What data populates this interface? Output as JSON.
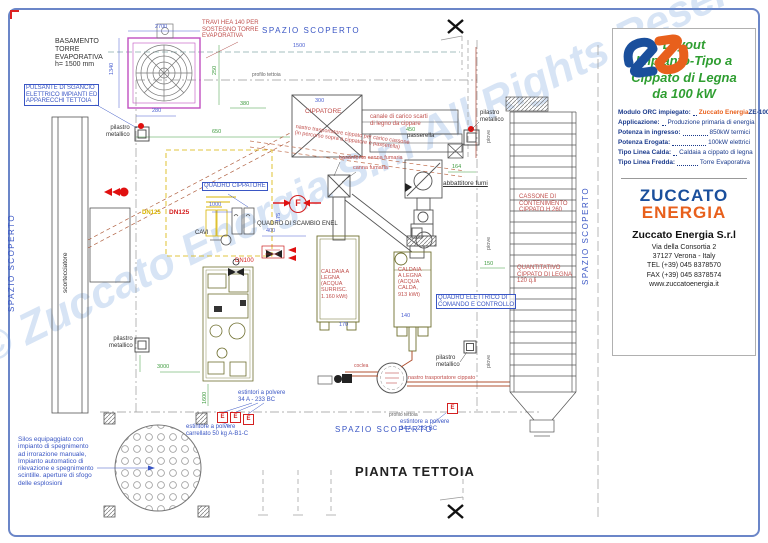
{
  "watermark": "© Zuccato Energia S.r.l All Rights Reserved",
  "panel": {
    "title": "Layout\nImpianto-Tipo a\nCippato di Legna\nda 100 kW",
    "specs": [
      {
        "label": "Modulo ORC impiegato:",
        "accent": "Zuccato Energia",
        "value": " ZE-100-LT"
      },
      {
        "label": "Applicazione:",
        "accent": "",
        "value": "Produzione primaria di energia"
      },
      {
        "label": "Potenza in ingresso:",
        "accent": "",
        "value": "850kW termici"
      },
      {
        "label": "Potenza Erogata:",
        "accent": "",
        "value": "100kW elettrici"
      },
      {
        "label": "Tipo Linea Calda:",
        "accent": "",
        "value": "Caldaia a cippato di legna"
      },
      {
        "label": "Tipo Linea Fredda:",
        "accent": "",
        "value": "Torre Evaporativa"
      }
    ],
    "brand1": "ZUCCATO",
    "brand2": "ENERGIA",
    "company": "Zuccato Energia S.r.l",
    "address": "Via della Consortia 2\n37127 Verona - Italy\nTEL (+39) 045 8378570\nFAX (+39) 045 8378574\nwww.zuccatoenergia.it"
  },
  "labels": {
    "basamento": "BASAMENTO\nTORRE\nEVAPORATIVA\nh= 1500 mm",
    "travi": "TRAVI HEA 140 PER\nSOSTEGNO TORRE\nEVAPORATIVA",
    "pulsante": "PULSANTE DI SGANCIO\nELETTRICO IMPIANTI ED\nAPPARECCHI TETTOIA",
    "pilastro": "pilastro\nmetallico",
    "spazio_scoperto": "SPAZIO SCOPERTO",
    "pianta_tettoia": "PIANTA TETTOIA",
    "scortecciatore": "scortecciatore",
    "cippatore": "CIPPATORE",
    "canale": "canale di carico scarti\ndi legno da cippare",
    "passerella": "passerella",
    "nastro_diag": "nastro trasportatore cippato per carico cassone\n(in percorso sopra a cippatore e passerella)",
    "basamento_canna": "basamento canna fumaria",
    "canna_fumaria": "canna fumaria",
    "abbattitore": "abbattitore fumi",
    "cassone": "CASSONE DI\nCONTENIMENTO\nCIPPATO H 260",
    "quantitativo": "QUANTITATIVO\nCIPPATO DI LEGNA\n120 q.li",
    "caldaia1": "CALDAIA A\nLEGNA\n(ACQUA\nSURRISC.\n1.160 kWt)",
    "caldaia2": "CALDAIA\nA LEGNA\n(ACQUA\nCALDA,\n913 kWt)",
    "quadro_cippatore": "QUADRO CIPPATORE",
    "quadro_scambio": "QUADRO DI SCAMBIO ENEL",
    "quadro_elettrico": "QUADRO ELETTRICO DI\nCOMANDO E CONTROLLO",
    "cavi": "CAVI",
    "coclea": "coclea",
    "nastro_bottom": "nastro trasportatore cippato",
    "silos_note": "Silos equipaggiato con\nimpianto di spegnimento\nad irrorazione manuale,\nImpianto automatico di\nrilevazione e spegnimento\nscintille. aperture di sfogo\ndelle esplosioni",
    "estintori_sx": "estintori a polvere\n34 A - 233 BC",
    "estintore_carrellato": "estintore a polvere\ncarrellato 50 kg A-B1-C",
    "estintore_dx": "estintore a polvere\n34 A - 233 BC",
    "profilo_tettoia": "profilo tettoia",
    "piove": "piove",
    "dn125": "DN125",
    "dn100": "DN100",
    "f": "F",
    "e": "E"
  },
  "dims": [
    "2700",
    "1340",
    "280",
    "250",
    "380",
    "650",
    "1500",
    "300",
    "450",
    "400",
    "1000",
    "175",
    "170",
    "140",
    "164",
    "150",
    "3000",
    "1600"
  ]
}
